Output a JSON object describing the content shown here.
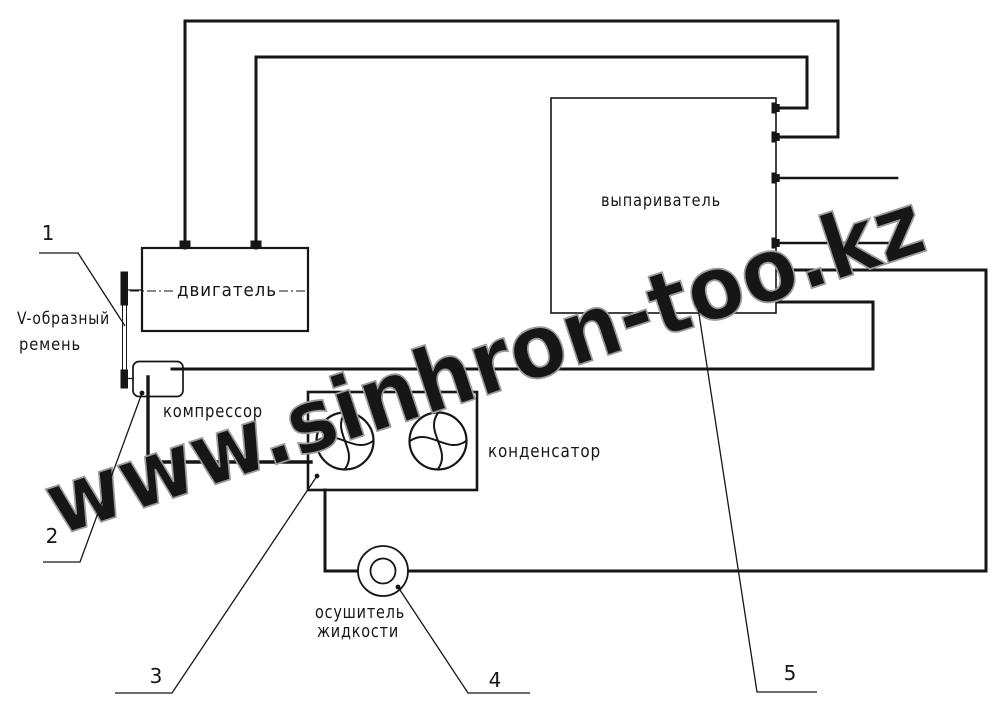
{
  "colors": {
    "line": "#161616",
    "watermark_outline": "#9b9b9b",
    "background": "#ffffff"
  },
  "watermark": {
    "text": "www.sinhron-too.kz"
  },
  "components": {
    "engine": {
      "label": "двигатель"
    },
    "evaporator": {
      "label": "выпариватель"
    },
    "compressor": {
      "label": "компрессор"
    },
    "condenser": {
      "label": "конденсатор"
    },
    "liquid_dryer": {
      "label_line1": "осушитель",
      "label_line2": "жидкости"
    },
    "v_belt": {
      "label_line1": "V-образный",
      "label_line2": "ремень"
    }
  },
  "callouts": [
    {
      "number": "1",
      "points_to": "v-belt"
    },
    {
      "number": "2",
      "points_to": "compressor"
    },
    {
      "number": "3",
      "points_to": "condenser"
    },
    {
      "number": "4",
      "points_to": "liquid-dryer"
    },
    {
      "number": "5",
      "points_to": "evaporator"
    }
  ]
}
